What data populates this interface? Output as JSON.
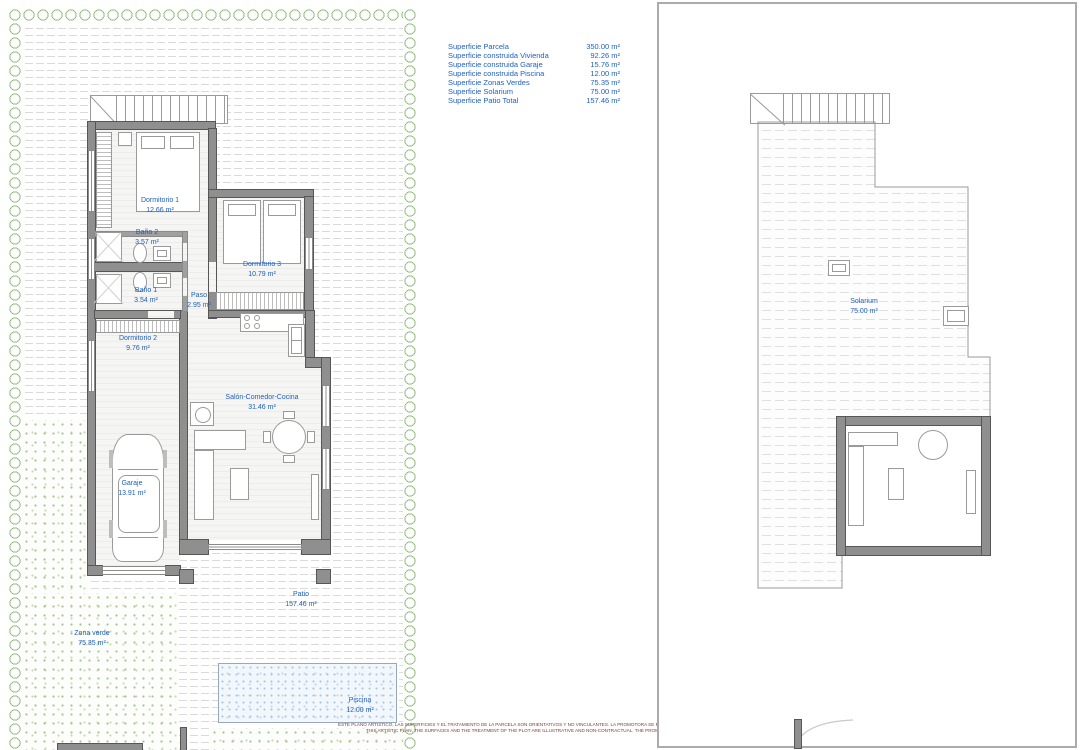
{
  "surface_table": {
    "rows": [
      {
        "label": "Superficie Parcela",
        "value": "350.00 m²"
      },
      {
        "label": "Superficie construida Vivienda",
        "value": "92.26 m²"
      },
      {
        "label": "Superficie construida Garaje",
        "value": "15.76 m²"
      },
      {
        "label": "Superficie construida Piscina",
        "value": "12.00 m²"
      },
      {
        "label": "Superficie Zonas Verdes",
        "value": "75.35 m²"
      },
      {
        "label": "Superficie Solarium",
        "value": "75.00 m²"
      },
      {
        "label": "Superficie Patio Total",
        "value": "157.46 m²"
      }
    ]
  },
  "rooms": {
    "dormitorio1": {
      "name": "Dormitorio 1",
      "area": "12.66 m²"
    },
    "bano2": {
      "name": "Baño 2",
      "area": "3.57 m²"
    },
    "dormitorio3": {
      "name": "Dormitorio 3",
      "area": "10.79 m²"
    },
    "bano1": {
      "name": "Baño 1",
      "area": "3.54 m²"
    },
    "paso": {
      "name": "Paso",
      "area": "2.95 m²"
    },
    "dormitorio2": {
      "name": "Dormitorio 2",
      "area": "9.76 m²"
    },
    "salon": {
      "name": "Salón-Comedor-Cocina",
      "area": "31.46 m²"
    },
    "garaje": {
      "name": "Garaje",
      "area": "13.91 m²"
    },
    "zona_verde": {
      "name": "Zona verde",
      "area": "75.35 m²"
    },
    "patio": {
      "name": "Patio",
      "area": "157.46 m²"
    },
    "piscina": {
      "name": "Piscina",
      "area": "12.00 m²"
    },
    "solarium": {
      "name": "Solarium",
      "area": "75.00 m²"
    }
  },
  "disclaimer": {
    "line1_es": "ESTE PLANO ARTISTICO, LAS SUPERFICIES Y EL TRATAMIENTO DE LA PARCELA SON ORIENTATIVOS Y NO VINCULANTES. LA PROMOTORA SE RESERVA EL DERECHO A EFECTUAR MODIFICACIONES POR CUALQUIER NECESIDAD",
    "line2_en": "THIS ARTISTIC PLAN, THE SURFACES AND THE TREATMENT OF THE PLOT ARE ILLUSTRATIVE AND NON-CONTRACTUAL. THE PROMOTER RESERVES THE RIGHT OF MAKING CHANGES DUE TO ANY NECESSITY"
  },
  "colors": {
    "label_blue": "#2060bf",
    "wall_gray": "#8f8f8f",
    "hedge_green": "#8cbb77",
    "pool_blue": "#a9c4e0",
    "disclaimer_red": "#7c3a3a"
  }
}
